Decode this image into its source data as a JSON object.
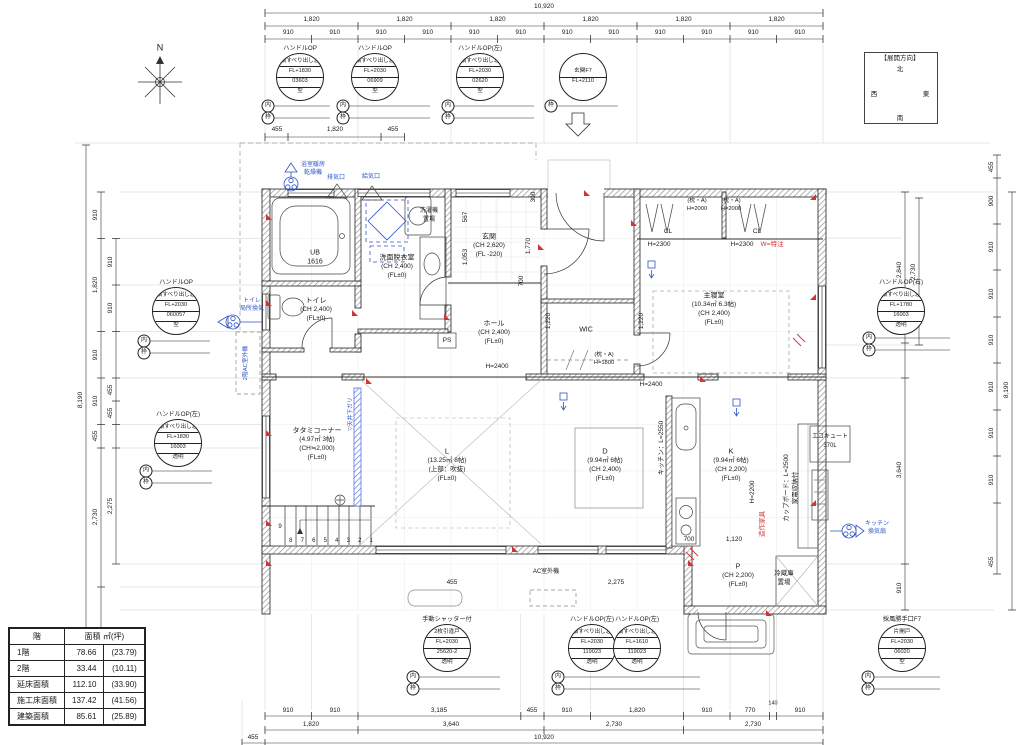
{
  "compass": {
    "frame_label": "【展開方向】",
    "north": "北",
    "west": "西",
    "east": "東",
    "south": "南"
  },
  "north_mark": "N",
  "area_table": {
    "col1": "階",
    "col2": "面積 ㎡(坪)",
    "rows": [
      {
        "label": "1階",
        "sqm": "78.66",
        "tsubo": "(23.79)"
      },
      {
        "label": "2階",
        "sqm": "33.44",
        "tsubo": "(10.11)"
      },
      {
        "label": "延床面積",
        "sqm": "112.10",
        "tsubo": "(33.90)"
      },
      {
        "label": "施工床面積",
        "sqm": "137.42",
        "tsubo": "(41.56)"
      },
      {
        "label": "建築面積",
        "sqm": "85.61",
        "tsubo": "(25.89)"
      }
    ]
  },
  "specs": [
    {
      "title": "ハンドルOP",
      "rows": [
        "横すべり出し窓",
        "FL+1830",
        "03603",
        "型"
      ],
      "b1": "内",
      "b2": "枠"
    },
    {
      "title": "ハンドルOP",
      "rows": [
        "横すべり出し窓",
        "FL+2030",
        "06909",
        "型"
      ],
      "b1": "内",
      "b2": "枠"
    },
    {
      "title": "ハンドルOP(左)",
      "rows": [
        "横すべり出し窓",
        "FL+2030",
        "02620",
        "型"
      ],
      "b1": "内",
      "b2": "枠"
    },
    {
      "title": "",
      "rows": [
        "玄関F7",
        "FL+2110"
      ],
      "b1": "枠"
    },
    {
      "title": "ハンドルOP",
      "rows": [
        "横すべり出し窓",
        "FL+2030",
        "060057",
        "型"
      ],
      "b1": "内",
      "b2": "枠"
    },
    {
      "title": "ハンドルOP(左)",
      "rows": [
        "横すべり出し窓",
        "FL+1830",
        "16003",
        "透明"
      ],
      "b1": "内",
      "b2": "枠"
    },
    {
      "title": "ハンドルOP(右)",
      "rows": [
        "横すべり出し窓",
        "FL+1780",
        "16003",
        "透明"
      ],
      "b1": "内",
      "b2": "枠"
    },
    {
      "title": "手動シャッター付",
      "rows": [
        "2枚引違戸",
        "FL+2030",
        "25620-2",
        "透明"
      ],
      "b1": "内",
      "b2": "枠"
    },
    {
      "title": "ハンドルOP(左)",
      "rows": [
        "横すべり出し窓",
        "FL+2030",
        "119023",
        "透明"
      ],
      "b1": "内",
      "b2": "枠"
    },
    {
      "title": "ハンドルOP(左)",
      "rows": [
        "横すべり出し窓",
        "FL+1610",
        "119023",
        "透明"
      ]
    },
    {
      "title": "採風勝手口F7",
      "rows": [
        "片開戸",
        "FL+2030",
        "06020",
        "型"
      ],
      "b1": "内",
      "b2": "枠"
    }
  ],
  "rooms": {
    "ub": [
      "UB",
      "1616"
    ],
    "senmen": [
      "洗面脱衣室",
      "(CH 2,400)",
      "(FL±0)"
    ],
    "genkan": [
      "玄関",
      "(CH 2,620)",
      "(FL -220)"
    ],
    "toilet": [
      "トイレ",
      "(CH 2,400)",
      "(FL±0)"
    ],
    "hall": [
      "ホール",
      "(CH 2,400)",
      "(FL±0)"
    ],
    "wic": "WIC",
    "shinshitsu": [
      "主寝室",
      "(10.34㎡ 6.3帖)",
      "(CH 2,400)",
      "(FL±0)"
    ],
    "tatami": [
      "タタミコーナー",
      "(4.97㎡ 3帖)",
      "(CH≒2,000)",
      "(FL±0)"
    ],
    "living": [
      "L",
      "(13.25㎡ 8帖)",
      "(上部：吹抜)",
      "(FL±0)"
    ],
    "dining": [
      "D",
      "(9.94㎡ 6帖)",
      "(CH 2,400)",
      "(FL±0)"
    ],
    "kitchen": [
      "K",
      "(9.94㎡ 6帖)",
      "(CH 2,200)",
      "(FL±0)"
    ],
    "pantry": [
      "P",
      "(CH 2,200)",
      "(FL±0)"
    ]
  },
  "fixtures": {
    "reizoko": [
      "冷蔵庫",
      "置場"
    ],
    "sentakuki": [
      "洗濯機",
      "置場"
    ],
    "ecocute": [
      "エコキュート",
      "370L"
    ],
    "ps": "PS"
  },
  "blue": {
    "bath_dry1": "浴室暖房",
    "bath_dry2": "乾燥機",
    "haiki": "排気口",
    "kyuki": "給気口",
    "toilet1": "トイレ",
    "toilet2": "局所換気",
    "kitchen1": "キッチン",
    "kitchen2": "換気扇",
    "ac2f": "2階AC室外機",
    "tenjo": "▽天井下ガリ"
  },
  "ac_out": "AC室外機",
  "red": {
    "w_special": "W=特注",
    "zosaku": "造作家具"
  },
  "closet": {
    "cl": "CL",
    "makura_a": "(枕・A)",
    "h2000": "H=2000",
    "h2300": "H=2300",
    "h1800": "H=1800",
    "h2400": "H=2400"
  },
  "kitchen_notes": {
    "kitchen_l": "キッチン：L=2550",
    "h2200": "H=2200",
    "cupboard": "カップボード：L=2500",
    "kaden": "家電収納付"
  },
  "stairs": {
    "top": "9",
    "row": [
      "8",
      "7",
      "6",
      "5",
      "4",
      "3",
      "2",
      "1"
    ]
  },
  "dims": {
    "top": {
      "total": "10,920",
      "r1820": [
        "1,820",
        "1,820",
        "1,820",
        "1,820",
        "1,820",
        "1,820"
      ],
      "r910": [
        "910",
        "910",
        "910",
        "910",
        "910",
        "910",
        "910",
        "910",
        "910",
        "910",
        "910",
        "910"
      ],
      "bath": [
        "455",
        "1,820",
        "455"
      ]
    },
    "bottom": {
      "r1": [
        "910",
        "910",
        "3,185",
        "455",
        "910",
        "1,820",
        "910",
        "770",
        "140",
        "910"
      ],
      "r2": [
        "1,820",
        "3,640",
        "2,730",
        "2,730"
      ],
      "total": "10,920",
      "offset": "455"
    },
    "left": {
      "total": "8,190",
      "c2": [
        "910",
        "1,820",
        "910",
        "910",
        "455",
        "2,730",
        "910",
        "910"
      ],
      "c3": [
        "910",
        "910",
        "455",
        "455",
        "2,275"
      ]
    },
    "right": {
      "total": "8,190",
      "outer": [
        "455",
        "900",
        "910",
        "910",
        "910",
        "910",
        "910",
        "910",
        "455"
      ],
      "inner": [
        "2,840",
        "2,730",
        "3,640",
        "910"
      ]
    },
    "inner": {
      "d567": "567",
      "d1053": "1,053",
      "d1770": "1,770",
      "d300": "300",
      "d700a": "700",
      "d1220a": "1,220",
      "d1220b": "1,220",
      "d700b": "700",
      "d1120": "1,120",
      "d455": "455",
      "d2275": "2,275"
    }
  }
}
